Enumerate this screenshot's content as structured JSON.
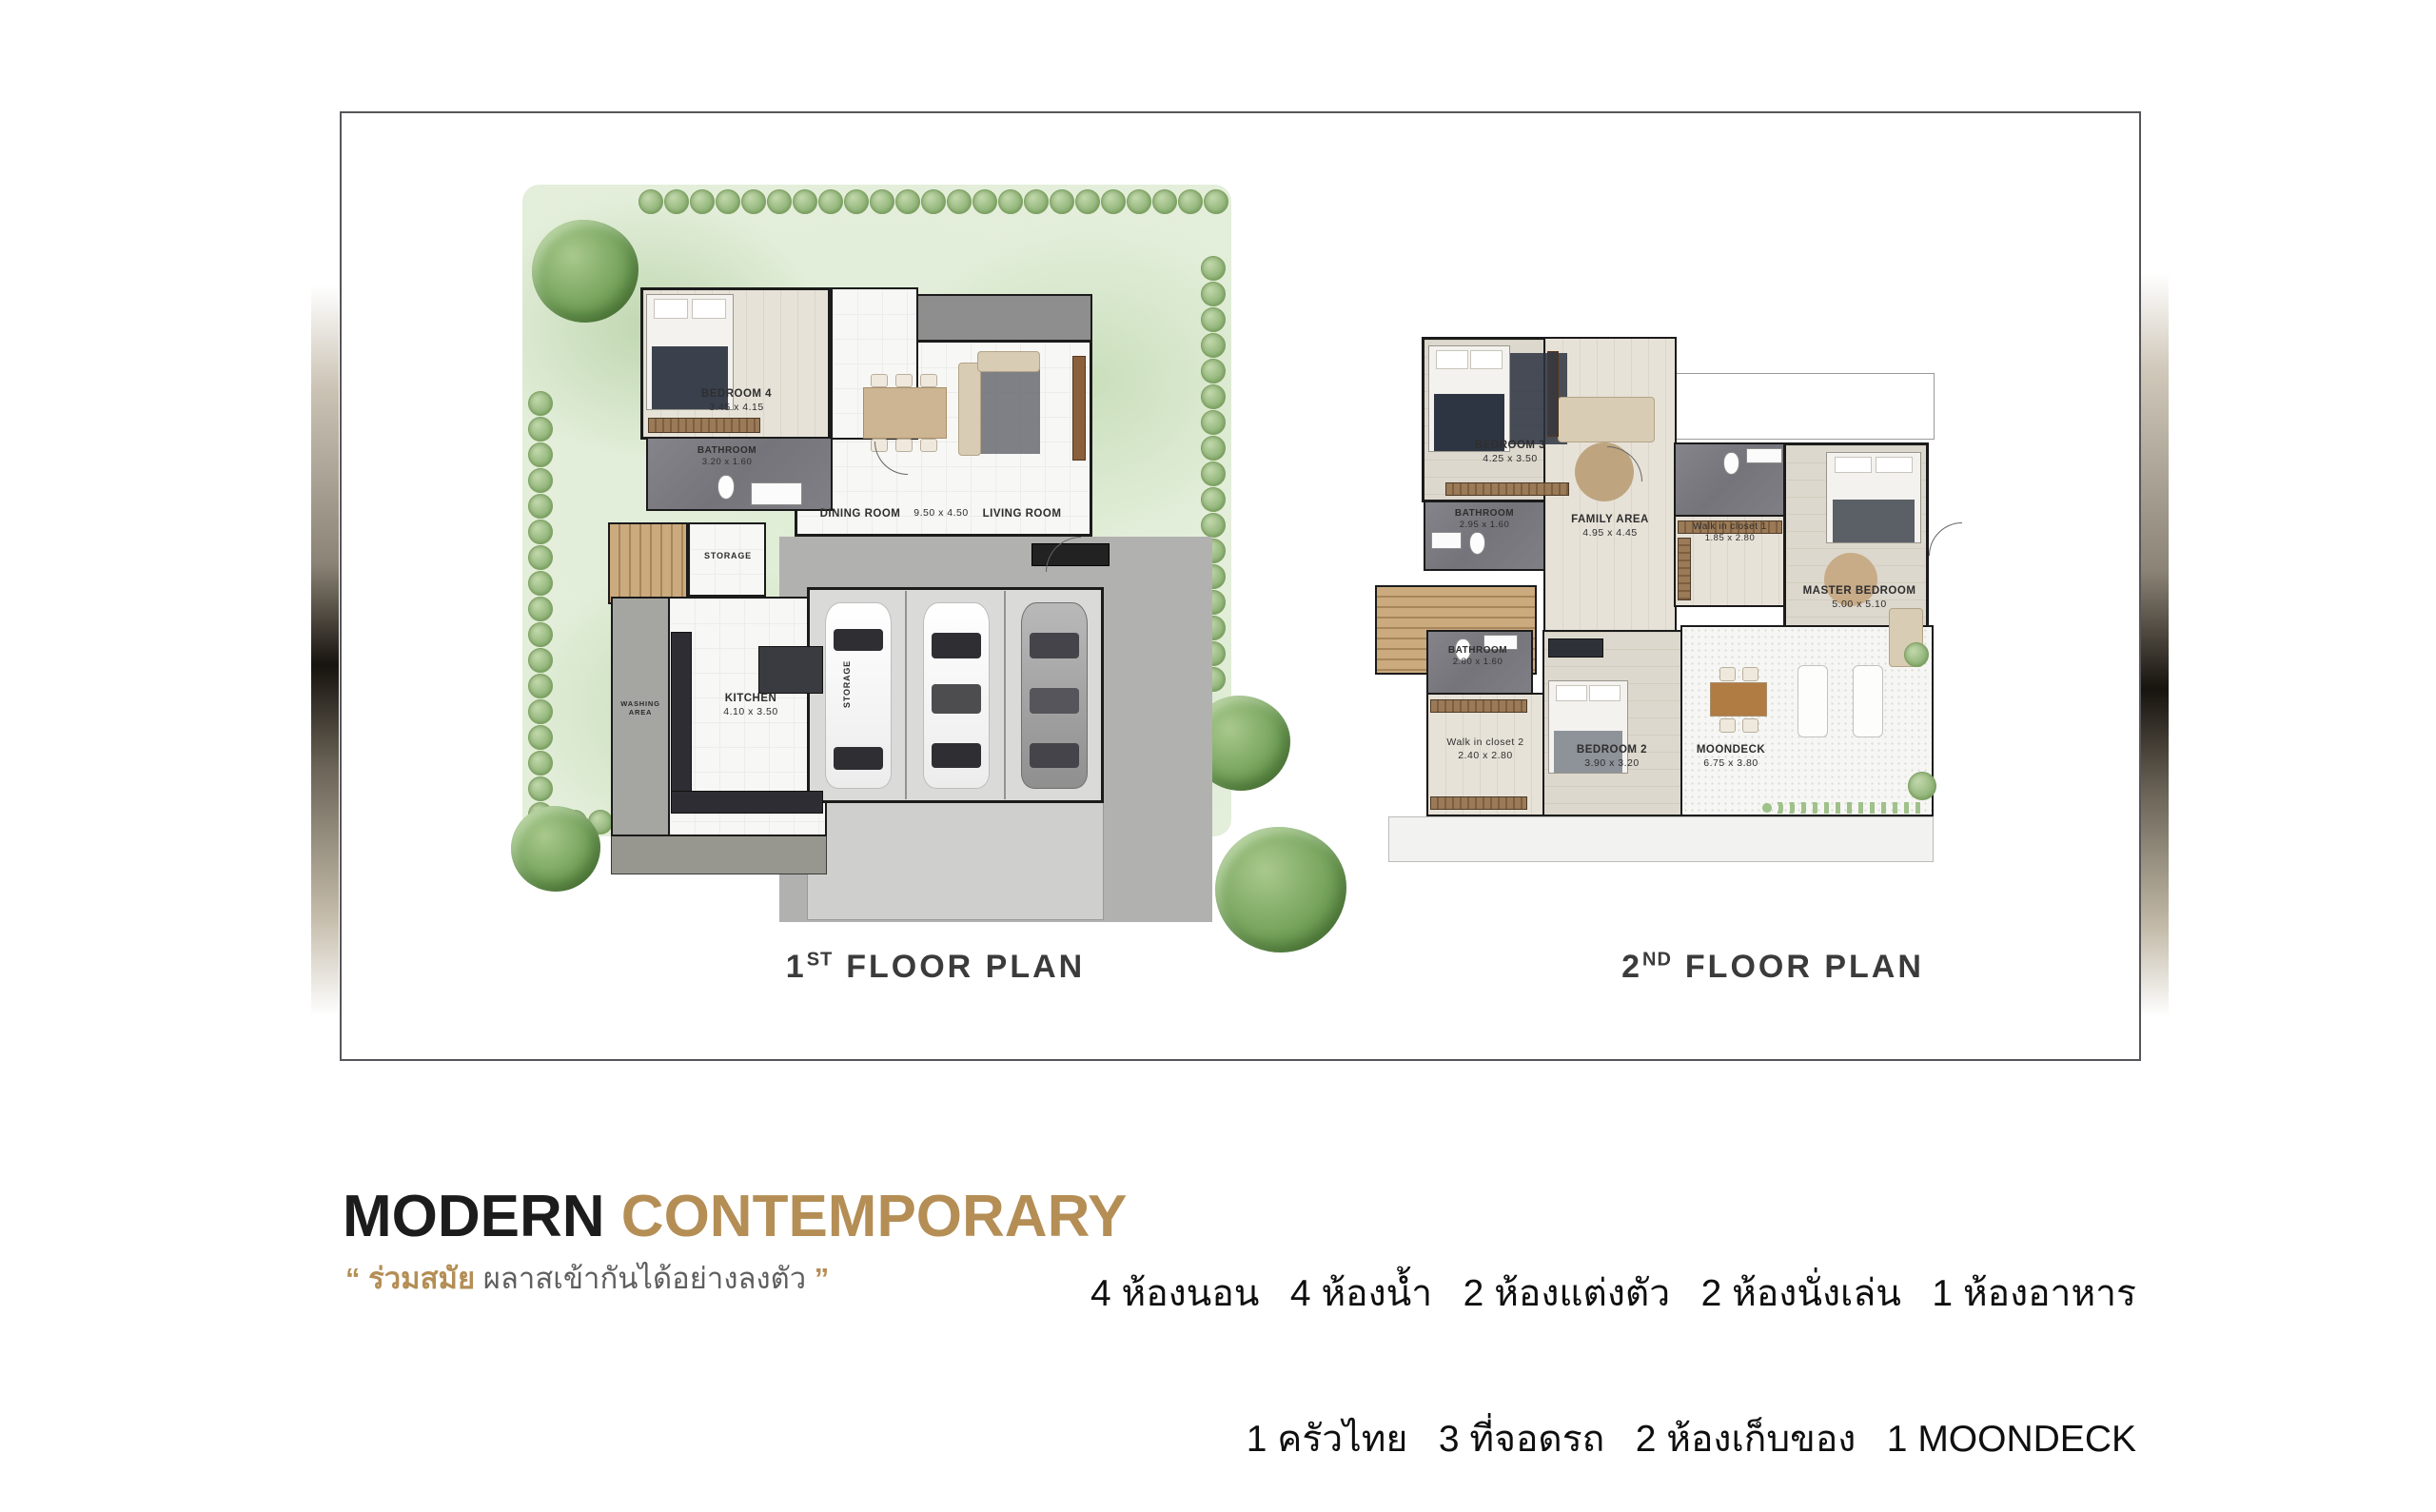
{
  "colors": {
    "accent_gold": "#b48e55",
    "wall": "#1b1b1b",
    "landscape_green": "#cfe3c4"
  },
  "floor1": {
    "caption": {
      "num": "1",
      "sup": "ST",
      "rest": "FLOOR PLAN"
    },
    "rooms": {
      "bedroom4": {
        "name": "BEDROOM 4",
        "dim": "3.45 x 4.15"
      },
      "bathroom": {
        "name": "BATHROOM",
        "dim": "3.20 x 1.60"
      },
      "dining": {
        "name": "DINING ROOM"
      },
      "dining_dim": {
        "dim": "9.50 x 4.50"
      },
      "living": {
        "name": "LIVING ROOM"
      },
      "storage": {
        "name": "STORAGE"
      },
      "storage2": {
        "name": "STORAGE"
      },
      "kitchen": {
        "name": "KITCHEN",
        "dim": "4.10 x 3.50"
      },
      "washing": {
        "name": "WASHING AREA"
      }
    }
  },
  "floor2": {
    "caption": {
      "num": "2",
      "sup": "ND",
      "rest": "FLOOR PLAN"
    },
    "rooms": {
      "bedroom3": {
        "name": "BEDROOM 3",
        "dim": "4.25 x 3.50"
      },
      "bathroom_top": {
        "name": "BATHROOM",
        "dim": "2.95 x 1.60"
      },
      "family": {
        "name": "FAMILY AREA",
        "dim": "4.95 x 4.45"
      },
      "wic1": {
        "name": "Walk in closet 1",
        "dim": "1.85 x 2.80"
      },
      "master": {
        "name": "MASTER BEDROOM",
        "dim": "5.00 x 5.10"
      },
      "bathroom_low": {
        "name": "BATHROOM",
        "dim": "2.80 x 1.60"
      },
      "wic2": {
        "name": "Walk in  closet 2",
        "dim": "2.40 x 2.80"
      },
      "bedroom2": {
        "name": "BEDROOM 2",
        "dim": "3.90 x 3.20"
      },
      "moondeck": {
        "name": "MOONDECK",
        "dim": "6.75 x 3.80"
      }
    }
  },
  "footer": {
    "title_primary": "MODERN",
    "title_accent": "CONTEMPORARY",
    "quote_open": "“",
    "quote_accent": "ร่วมสมัย",
    "quote_text": "ผลาสเข้ากันได้อย่างลงตัว",
    "quote_close": "”",
    "summary_line1": "4 ห้องนอน   4 ห้องน้ำ   2 ห้องแต่งตัว   2 ห้องนั่งเล่น   1 ห้องอาหาร",
    "summary_line2": "1 ครัวไทย   3 ที่จอดรถ   2 ห้องเก็บของ   1 MOONDECK"
  }
}
